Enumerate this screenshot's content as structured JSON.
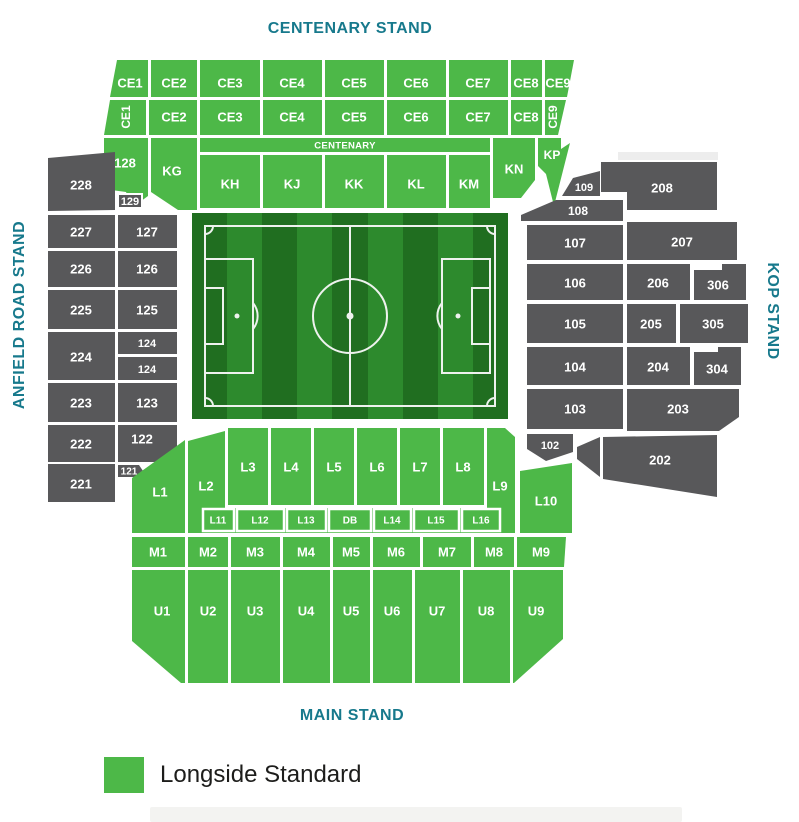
{
  "stand_labels": {
    "top": "CENTENARY STAND",
    "left": "ANFIELD ROAD STAND",
    "right": "KOP STAND",
    "bottom": "MAIN STAND"
  },
  "legend": {
    "label": "Longside Standard",
    "swatch_color": "#4db848"
  },
  "colors": {
    "available_green": "#4db848",
    "unavailable_gray": "#58585a",
    "stand_label_teal": "#17798c",
    "pitch_dark": "#206e20",
    "pitch_light": "#2d8a2d"
  },
  "sections": {
    "ce_row1": [
      "CE1",
      "CE2",
      "CE3",
      "CE4",
      "CE5",
      "CE6",
      "CE7",
      "CE8",
      "CE9"
    ],
    "ce_row2": [
      "CE1",
      "CE2",
      "CE3",
      "CE4",
      "CE5",
      "CE6",
      "CE7",
      "CE8",
      "CE9"
    ],
    "centenary_strip": "CENTENARY",
    "krow": [
      "128",
      "KG",
      "KH",
      "KJ",
      "KK",
      "KL",
      "KM",
      "KN",
      "KP"
    ],
    "anfield_outer": [
      "228",
      "227",
      "226",
      "225",
      "224",
      "223",
      "222",
      "221"
    ],
    "anfield_inner": [
      "129",
      "127",
      "126",
      "125",
      "124",
      "124",
      "123",
      "122",
      "121"
    ],
    "kop": [
      "109",
      "208",
      "108",
      "107",
      "207",
      "106",
      "206",
      "306",
      "105",
      "205",
      "305",
      "104",
      "204",
      "304",
      "103",
      "203",
      "102",
      "202"
    ],
    "lrow": [
      "L1",
      "L2",
      "L3",
      "L4",
      "L5",
      "L6",
      "L7",
      "L8",
      "L9",
      "L10"
    ],
    "lstrip": [
      "L11",
      "L12",
      "L13",
      "DB",
      "L14",
      "L15",
      "L16"
    ],
    "mrow": [
      "M1",
      "M2",
      "M3",
      "M4",
      "M5",
      "M6",
      "M7",
      "M8",
      "M9"
    ],
    "urow": [
      "U1",
      "U2",
      "U3",
      "U4",
      "U5",
      "U6",
      "U7",
      "U8",
      "U9"
    ]
  }
}
